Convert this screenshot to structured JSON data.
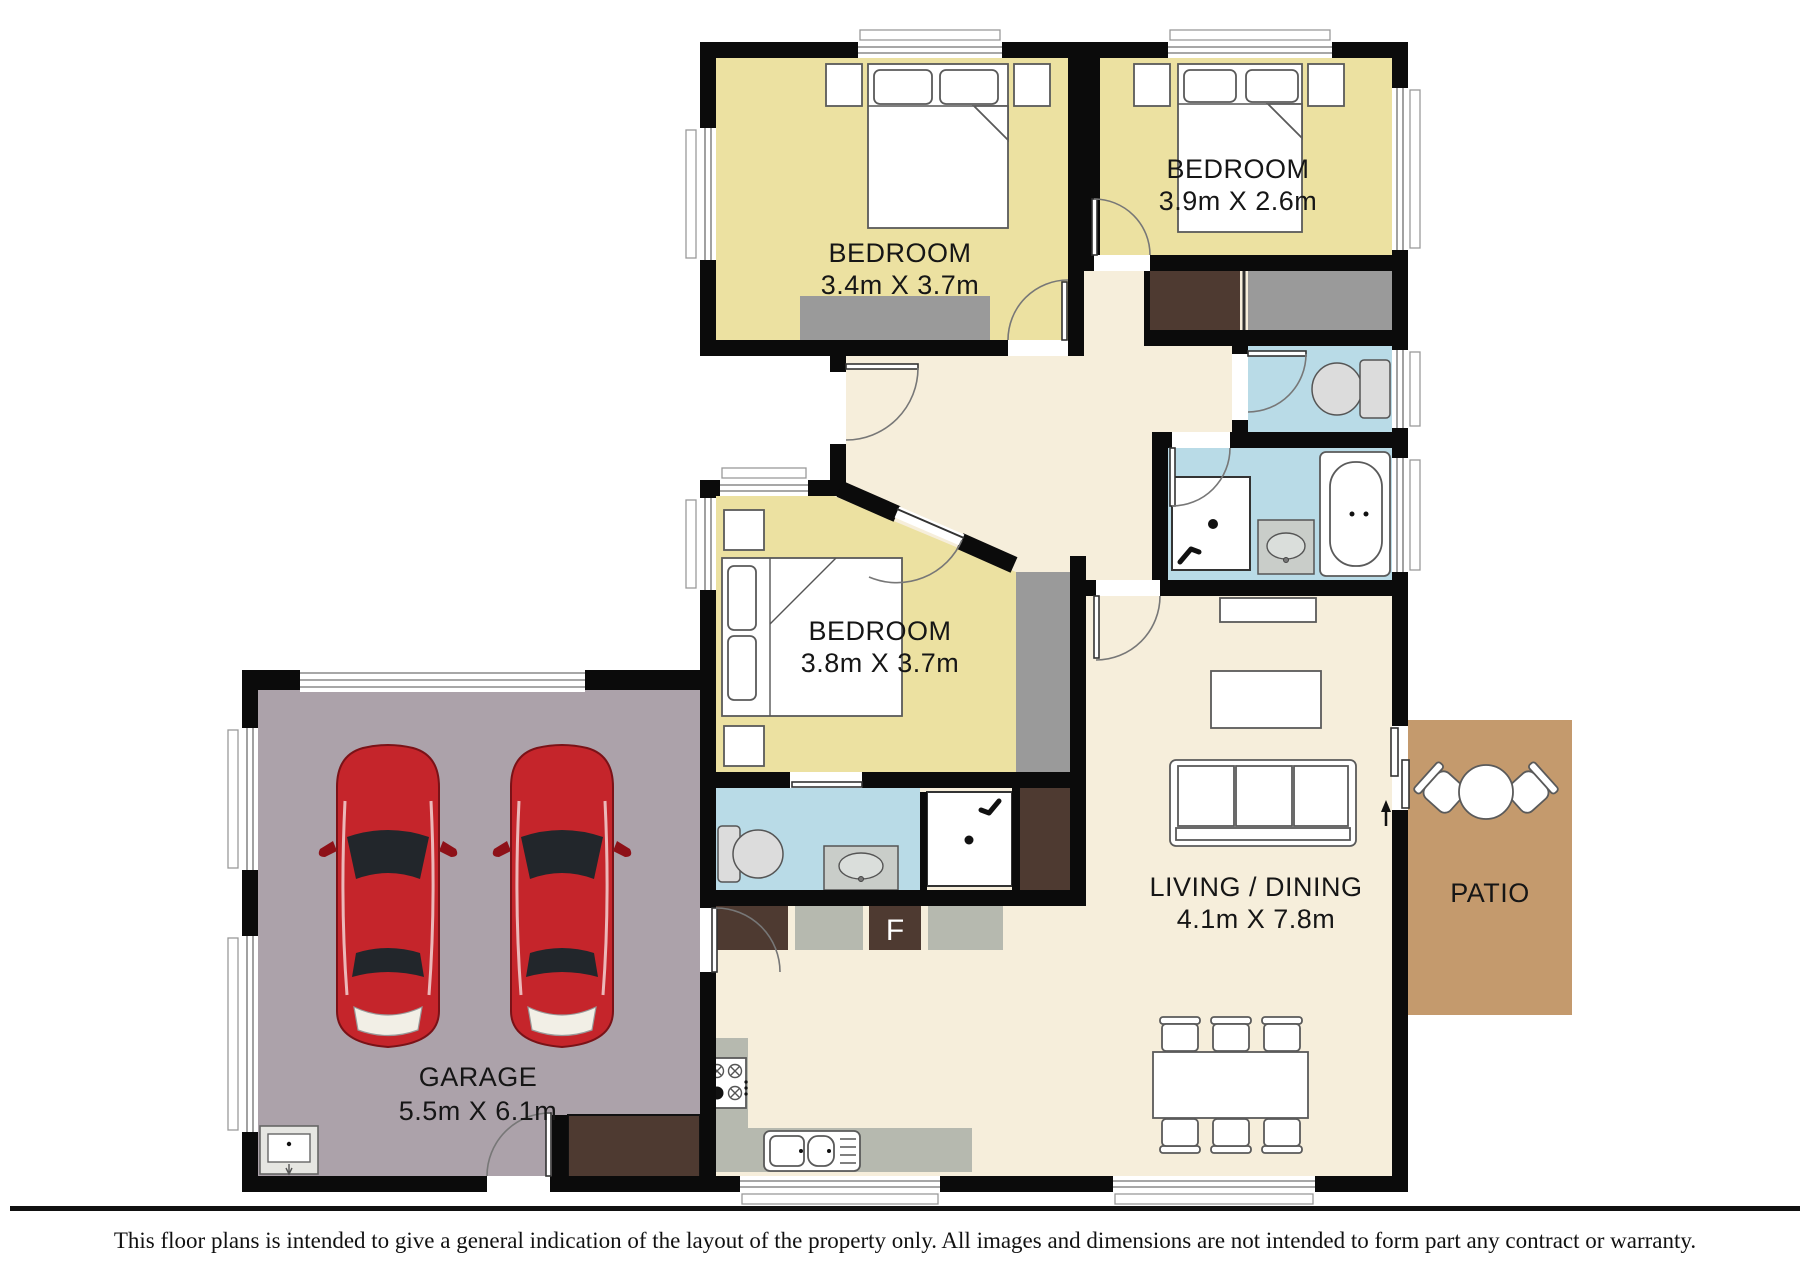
{
  "rooms": {
    "bedroom_top_left": {
      "name": "BEDROOM",
      "dims": "3.4m X 3.7m"
    },
    "bedroom_top_right": {
      "name": "BEDROOM",
      "dims": "3.9m X 2.6m"
    },
    "bedroom_middle": {
      "name": "BEDROOM",
      "dims": "3.8m X 3.7m"
    },
    "living_dining": {
      "name": "LIVING / DINING",
      "dims": "4.1m X 7.8m"
    },
    "garage": {
      "name": "GARAGE",
      "dims": "5.5m X 6.1m"
    },
    "patio": {
      "name": "PATIO"
    }
  },
  "labels": {
    "fridge": "F"
  },
  "colors": {
    "floor": "#f6eedb",
    "bedroom": "#ece1a1",
    "wet_room": "#b9dbe7",
    "garage_floor": "#aca2aa",
    "patio": "#c49a6d",
    "wardrobe_dark": "#4e3a31",
    "wardrobe_gray": "#9a9a9a",
    "cabinet_gray": "#b6b9af",
    "wall": "#0b0b0b",
    "car": "#c5252b"
  },
  "footer": {
    "disclaimer": "This floor plans is intended to give a general indication of the layout of the property only. All images and dimensions are not intended to form part any contract or warranty."
  }
}
